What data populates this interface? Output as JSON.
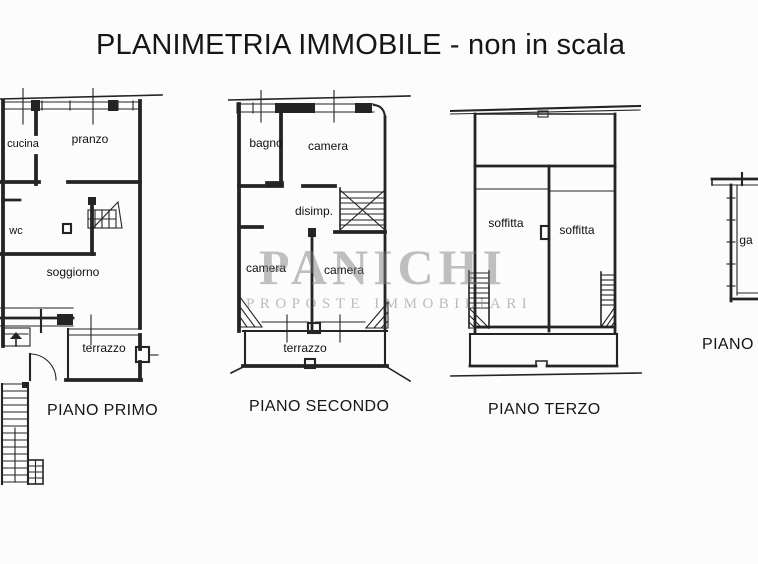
{
  "title": "PLANIMETRIA IMMOBILE - non in scala",
  "watermark": {
    "brand": "PANICHI",
    "tagline": "PROPOSTE IMMOBILIARI"
  },
  "colors": {
    "line": "#242424",
    "watermark_gray": "#7d7d7d",
    "background": "#fcfcfc"
  },
  "floors": [
    {
      "name": "PIANO PRIMO",
      "rooms": {
        "cucina": "cucina",
        "pranzo": "pranzo",
        "wc": "wc",
        "soggiorno": "soggiorno",
        "terrazzo": "terrazzo"
      }
    },
    {
      "name": "PIANO SECONDO",
      "rooms": {
        "bagno": "bagno",
        "camera_top": "camera",
        "disimpegno": "disimp.",
        "camera_left": "camera",
        "camera_right": "camera",
        "terrazzo": "terrazzo"
      }
    },
    {
      "name": "PIANO TERZO",
      "rooms": {
        "soffitta_left": "soffitta",
        "soffitta_right": "soffitta"
      }
    },
    {
      "name": "PIANO T",
      "rooms": {
        "garage_partial": "ga"
      }
    }
  ]
}
